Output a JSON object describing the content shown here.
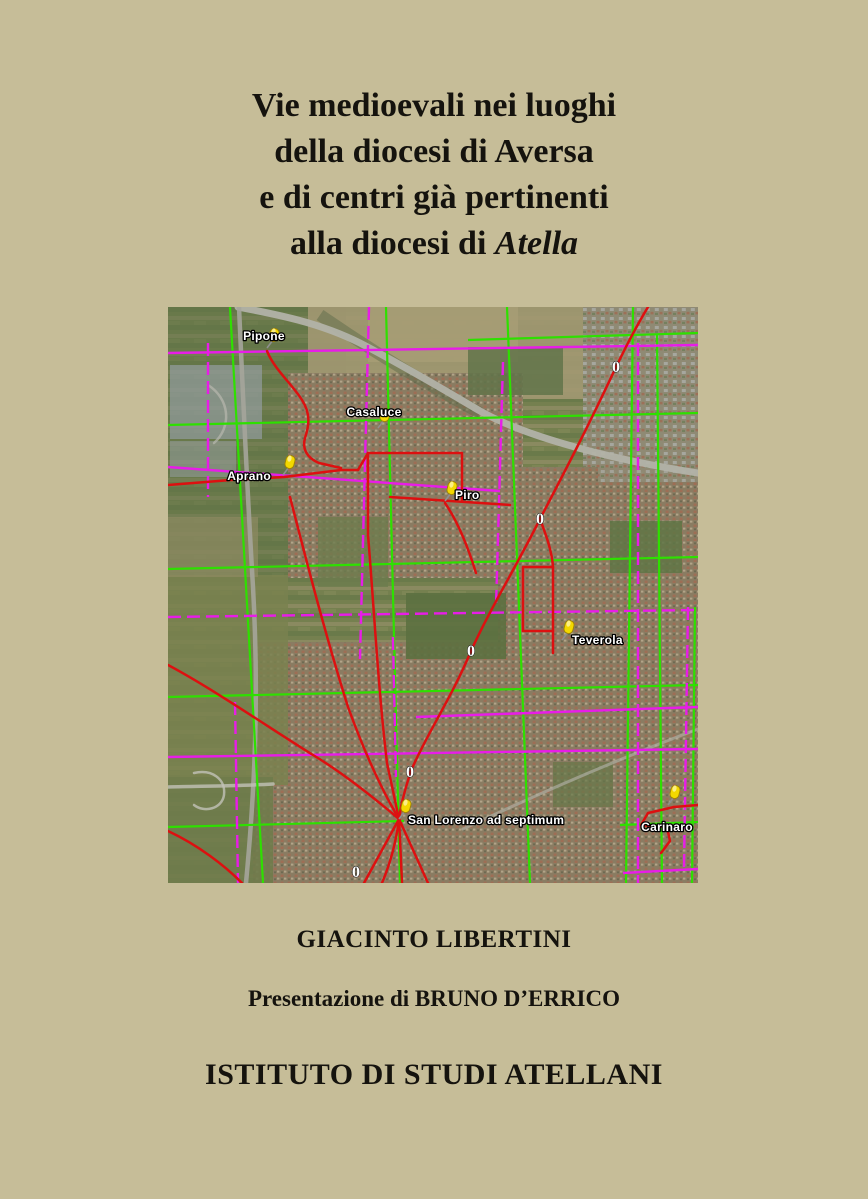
{
  "page": {
    "background_color": "#c6bd98"
  },
  "title": {
    "line1": "Vie medioevali nei luoghi",
    "line2": "della diocesi di Aversa",
    "line3": "e di centri già pertinenti",
    "line4_prefix": "alla diocesi di ",
    "line4_italic": "Atella"
  },
  "credits": {
    "author": "GIACINTO LIBERTINI",
    "presentation": "Presentazione di BRUNO D’ERRICO",
    "institute": "ISTITUTO DI STUDI ATELLANI"
  },
  "map": {
    "description": "Satellite view of the Aversa / Atella plain with overlaid centuriation grids (green and magenta), medieval roads (red), yellow place pins and white zero markers",
    "overlay_colors": {
      "grid_green": "#2ee000",
      "grid_magenta": "#e81ce8",
      "roads_red": "#dd1010",
      "pin_yellow": "#f3d800",
      "label_text": "#ffffff",
      "zero_marker": "#ffffff"
    },
    "zero_glyph": "0",
    "pins": [
      {
        "name": "Pipone",
        "x": 99,
        "y": 41,
        "label_x": 96,
        "label_y": 33,
        "anchor": "middle"
      },
      {
        "name": "Casaluce",
        "x": 210,
        "y": 121,
        "label_x": 206,
        "label_y": 109,
        "anchor": "middle"
      },
      {
        "name": "Aprano",
        "x": 115,
        "y": 168,
        "label_x": 103,
        "label_y": 173,
        "anchor": "end"
      },
      {
        "name": "Piro",
        "x": 277,
        "y": 194,
        "label_x": 287,
        "label_y": 192,
        "anchor": "start"
      },
      {
        "name": "Teverola",
        "x": 394,
        "y": 333,
        "label_x": 404,
        "label_y": 337,
        "anchor": "start"
      },
      {
        "name": "San Lorenzo ad septimum",
        "x": 231,
        "y": 512,
        "label_x": 240,
        "label_y": 517,
        "anchor": "start"
      },
      {
        "name": "Carinaro",
        "x": 500,
        "y": 498,
        "label_x": 499,
        "label_y": 524,
        "anchor": "middle"
      }
    ],
    "zero_markers": [
      {
        "x": 448,
        "y": 65
      },
      {
        "x": 372,
        "y": 217
      },
      {
        "x": 303,
        "y": 349
      },
      {
        "x": 242,
        "y": 470
      },
      {
        "x": 188,
        "y": 570
      }
    ],
    "green_lines": [
      [
        62,
        0,
        95,
        576
      ],
      [
        218,
        0,
        232,
        576
      ],
      [
        339,
        0,
        362,
        576
      ],
      [
        465,
        0,
        458,
        576
      ],
      [
        489,
        28,
        494,
        576
      ],
      [
        527,
        300,
        524,
        576
      ],
      [
        0,
        118,
        530,
        106
      ],
      [
        0,
        262,
        530,
        250
      ],
      [
        0,
        390,
        530,
        378
      ],
      [
        0,
        520,
        236,
        514
      ],
      [
        300,
        33,
        530,
        26
      ],
      [
        452,
        518,
        530,
        515
      ]
    ],
    "magenta_lines": [
      [
        0,
        46,
        530,
        38
      ],
      [
        0,
        160,
        332,
        184
      ],
      [
        0,
        310,
        530,
        303,
        "d"
      ],
      [
        248,
        410,
        530,
        400
      ],
      [
        0,
        450,
        530,
        442
      ],
      [
        455,
        566,
        530,
        562
      ],
      [
        201,
        0,
        192,
        352,
        "d"
      ],
      [
        40,
        36,
        40,
        190,
        "d"
      ],
      [
        335,
        55,
        328,
        300,
        "d"
      ],
      [
        470,
        36,
        470,
        576,
        "d"
      ],
      [
        67,
        395,
        70,
        576,
        "d"
      ],
      [
        225,
        330,
        228,
        470,
        "d"
      ],
      [
        520,
        300,
        516,
        560,
        "d"
      ]
    ],
    "red_routes": [
      "M480,0 C462,30 456,44 448,60 C420,120 396,166 372,212 C348,260 322,302 303,344 C284,390 256,432 243,464 C237,482 233,497 231,512 C228,536 222,557 214,576",
      "M231,512 L196,576",
      "M231,512 L234,576",
      "M231,512 L260,576",
      "M99,44 C106,62 124,77 134,93 C143,107 141,119 137,131 C134,142 139,151 151,156 L173,161",
      "M0,178 L63,173 L116,170 L173,163 L190,163",
      "M190,163 L200,146 L294,146 L294,194",
      "M222,190 L342,198",
      "M277,196 C290,215 300,240 308,266",
      "M200,146 L200,228 C206,300 210,380 219,456 L231,512",
      "M122,190 C140,260 158,330 180,400 C196,444 212,480 231,512",
      "M0,358 C45,382 100,420 145,448 C175,466 205,490 231,512",
      "M0,524 C30,538 56,558 74,576",
      "M372,212 C378,228 384,244 385,260",
      "M355,260 L385,260 M385,260 L385,346 M355,260 L355,324 L385,324",
      "M530,498 L506,500 L480,506 L473,518 L499,520 L502,534 L493,546"
    ],
    "gray_roads": [
      {
        "d": "M70,0 C112,8 152,16 192,36 C238,60 278,84 312,104 C362,132 452,154 530,166",
        "w": 7,
        "color": "#b2b2a8",
        "opacity": 0.95
      },
      {
        "d": "M71,0 C75,90 79,180 85,280 C91,390 87,480 78,576",
        "w": 4.5,
        "color": "#a5a59b",
        "opacity": 0.9
      },
      {
        "d": "M295,522 C370,487 450,452 530,422",
        "w": 3,
        "color": "#b0b0a6",
        "opacity": 0.65
      },
      {
        "d": "M0,480 C40,479 70,479 105,477",
        "w": 3.5,
        "color": "#c2c2b8",
        "opacity": 0.8
      },
      {
        "d": "M26,466 C44,462 58,472 56,488 C54,502 36,506 26,498",
        "w": 2.5,
        "color": "#c2c2b8",
        "opacity": 0.8
      },
      {
        "d": "M40,78 C62,92 64,120 46,136",
        "w": 2.5,
        "color": "#b8b8ae",
        "opacity": 0.7
      }
    ]
  }
}
